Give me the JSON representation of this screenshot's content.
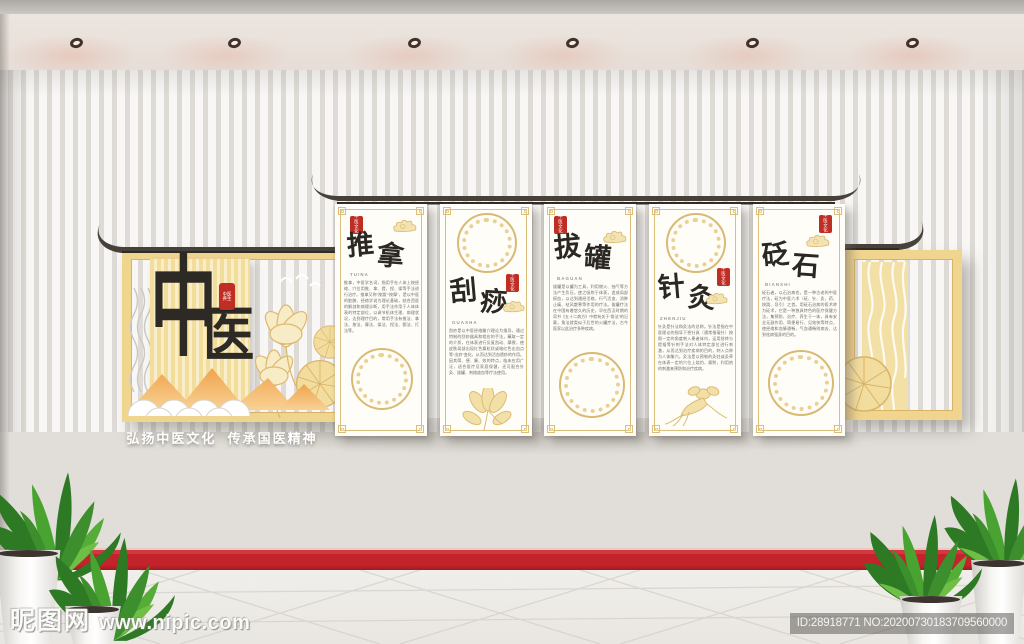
{
  "meta": {
    "site_logo": "昵图网",
    "site_url": "www.nipic.com",
    "image_id": "ID:28918771 NO:20200730183709560000"
  },
  "wall": {
    "brand_char_1": "中",
    "brand_char_2": "医",
    "brand_seal": "中医养生",
    "slogan": "弘扬中医文化  传承国医精神",
    "panels": [
      {
        "title": "推拿",
        "pinyin": "TUINA",
        "seal": "中医文化",
        "body": "推拿，中医学名词，指用手在人体上按经络、穴位用推、拿、提、捏、揉等手法进行治疗。推拿又称“按跷”“按摩”，是以中医的脏腑、经络学说为理论基础，结合西医的解剖和病理诊断，用手法作用于人体体表的特定部位，以调节机体生理、病理状况，达到理疗目的，常用手法有推法、拿法、按法、摩法、揉法、捏法、颤法、打法等。"
      },
      {
        "title": "刮痧",
        "pinyin": "GUASHA",
        "seal": "中医文化",
        "body": "刮痧是以中医经络腧穴理论为指导，通过特制的刮痧器具和相应的手法，蘸取一定的介质，在体表进行反复刮动、摩擦，使皮肤局部出现红色粟粒状或暗红色出血点等“出痧”变化，从而达到活血透痧的作用。因其简、便、廉、效的特点，临床应用广泛，适合医疗及家庭保健，还可配合针灸、拔罐、刺络放血等疗法使用。"
      },
      {
        "title": "拔罐",
        "pinyin": "BAGUAN",
        "seal": "中医文化",
        "body": "拔罐是以罐为工具，利用燃火、抽气等方法产生负压，使之吸附于体表，造成局部瘀血，以达到通经活络、行气活血、消肿止痛、祛风散寒等作用的疗法。拔罐疗法在中国有着悠久的历史，早在西汉时期的帛书《五十二病方》中就有关于“角法”的记载，角法就类似于后世的火罐疗法，古今医家以此治疗多种疾病。"
      },
      {
        "title": "针灸",
        "pinyin": "ZHENJIU",
        "seal": "中医文化",
        "body": "针灸是针法和灸法的总称。针法是指在中医理论的指导下把针具（通常指毫针）按照一定的角度刺入患者体内，运用捻转与提插等针刺手法对人体特定部位进行刺激，从而达到治疗疾病的目的，刺入点称为人体腧穴。灸法是以预制的灸炷或灸草在体表一定的穴位上烧灼、熏熨，利用热的刺激来预防和治疗疾病。"
      },
      {
        "title": "砭石",
        "pinyin": "BIANSHI",
        "seal": "中医文化",
        "body": "砭石者，以石治病也，是一种古老的中医疗法，砭为中医六术（砭、针、灸、药、按跷、导引）之首。用砭石治病的医术称为砭术，它是一种独具特色的医疗保健方法，集预防、治疗、养生于一体，具有安全无副作用、简便易行、见效快等特点，使经络和血脉通畅，气血通畅则病去，达到祛病强身的目的。"
      }
    ]
  }
}
